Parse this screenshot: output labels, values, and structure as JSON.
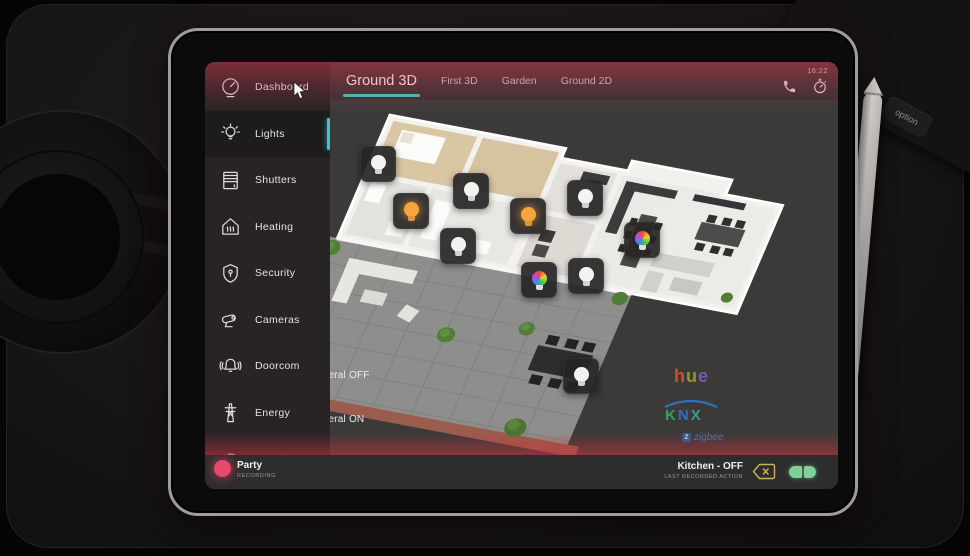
{
  "device": {
    "clock": "16:22",
    "keyboard_keys": [
      "control",
      "option"
    ]
  },
  "sidebar": {
    "items": [
      {
        "label": "Dashboard",
        "icon": "gauge-icon",
        "active": false
      },
      {
        "label": "Lights",
        "icon": "bulb-icon",
        "active": true
      },
      {
        "label": "Shutters",
        "icon": "shutters-icon",
        "active": false
      },
      {
        "label": "Heating",
        "icon": "heating-icon",
        "active": false
      },
      {
        "label": "Security",
        "icon": "shield-icon",
        "active": false
      },
      {
        "label": "Cameras",
        "icon": "camera-icon",
        "active": false
      },
      {
        "label": "Doorcom",
        "icon": "bell-icon",
        "active": false
      },
      {
        "label": "Energy",
        "icon": "pylon-icon",
        "active": false
      },
      {
        "label": "Weather",
        "icon": "cloud-icon",
        "active": false
      }
    ]
  },
  "tabs": {
    "items": [
      {
        "label": "Ground 3D",
        "active": true
      },
      {
        "label": "First 3D",
        "active": false
      },
      {
        "label": "Garden",
        "active": false
      },
      {
        "label": "Ground 2D",
        "active": false
      }
    ]
  },
  "scene_buttons": [
    {
      "label": "General OFF"
    },
    {
      "label": "General ON"
    }
  ],
  "logos": {
    "hue_letters": [
      "h",
      "u",
      "e"
    ],
    "knx_letters": [
      "K",
      "N",
      "X"
    ],
    "zigbee_badge": "Z",
    "zigbee_text": "zigbee"
  },
  "lights": [
    {
      "type": "white",
      "x": 172,
      "y": 101
    },
    {
      "type": "orange",
      "x": 205,
      "y": 148
    },
    {
      "type": "white",
      "x": 265,
      "y": 128
    },
    {
      "type": "white",
      "x": 252,
      "y": 183
    },
    {
      "type": "orange",
      "x": 322,
      "y": 153
    },
    {
      "type": "white",
      "x": 379,
      "y": 135
    },
    {
      "type": "color",
      "x": 436,
      "y": 177
    },
    {
      "type": "color",
      "x": 333,
      "y": 217
    },
    {
      "type": "white",
      "x": 380,
      "y": 213
    },
    {
      "type": "white",
      "x": 375,
      "y": 313
    }
  ],
  "statusbar": {
    "scene": "Party",
    "scene_sub": "RECORDING",
    "action": "Kitchen - OFF",
    "action_sub": "LAST RECORDED ACTION"
  },
  "colors": {
    "accent": "#3fc6cd",
    "record": "#e8496a",
    "toggle_green": "#7fd19a",
    "backspace_gold": "#c9b35a",
    "bulb_orange": "#f6a53c"
  }
}
